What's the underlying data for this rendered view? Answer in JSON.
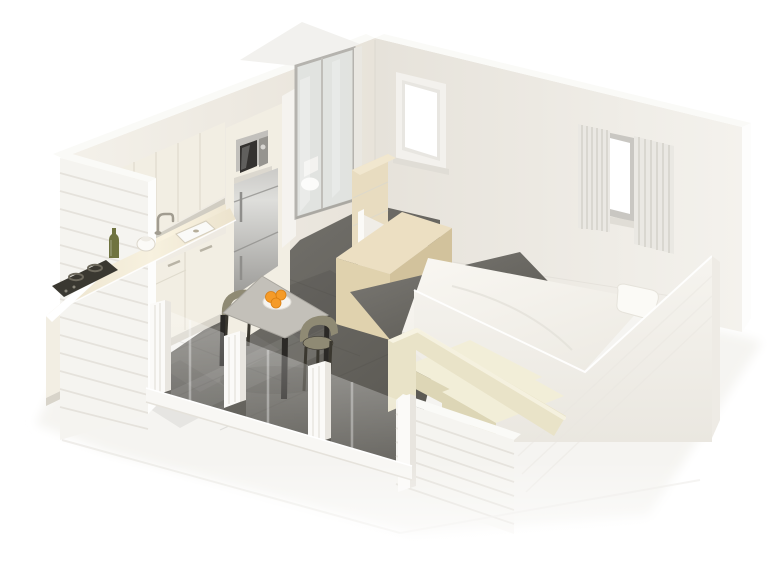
{
  "meta": {
    "title": "3D isometric cutaway floor plan of a small studio cabin",
    "type": "architectural-render",
    "view": "isometric-cutaway",
    "background": "white"
  },
  "scene": {
    "rooms": [
      {
        "name": "kitchen-dining",
        "furniture": [
          "upper cabinets",
          "countertop with sink and faucet",
          "cooktop",
          "base cabinets",
          "fridge",
          "microwave",
          "oil bottle",
          "kettle",
          "square dining table",
          "two olive chairs",
          "plate of oranges"
        ]
      },
      {
        "name": "bathroom",
        "furniture": [
          "glass shower-cabin enclosure",
          "toilet",
          "wooden vanity"
        ]
      },
      {
        "name": "bedroom-living",
        "furniture": [
          "double bed with white duvet",
          "pillow",
          "cream sofa",
          "wooden desk",
          "divider panel"
        ]
      }
    ],
    "openings": [
      "plain window on back-right wall",
      "curtained window on back-right wall",
      "glazed front with white mullions",
      "clapboard exterior walls"
    ]
  },
  "colors": {
    "bg": "#ffffff",
    "slab": "#f5f4f1",
    "wallTop": "#fafaf7",
    "wallNWl": "#f4f1ea",
    "wallNWr": "#e8e3da",
    "wallNEl": "#e6e2da",
    "wallNEr": "#f4f2ed",
    "wallCut": "#fdfdfc",
    "clapFace": "#f5f4f0",
    "clapLine": "#e3e0d9",
    "cabinet": "#f2eee3",
    "cabinetSeam": "#ded9cb",
    "cabinetShadow": "#c9c5ba",
    "counterA": "#f7f1df",
    "counterB": "#ece3cd",
    "backsplashA": "#faf3e0",
    "backsplashB": "#efe7d3",
    "cooktop": "#3a3831",
    "burner": "#6e6a5e",
    "steelA": "#cbcac7",
    "steelHi": "#dededb",
    "steelB": "#9c9b98",
    "steelSeam": "#8e8d8a",
    "mwFrame": "#c2c0bc",
    "mwGlass": "#343230",
    "mwPanel": "#96948f",
    "bathTop": "#f2f1ee",
    "bathSide": "#f5f3ef",
    "glassTint": "#dfe3df",
    "glassFrame": "#b5b3ae",
    "toilet": "#fbfbf9",
    "floorA": "#7d7b76",
    "floorB": "#55534d",
    "grout": "#3f3d38",
    "tableTopA": "#c3c0b9",
    "tableTopB": "#a8a59e",
    "tableLeg": "#2b2926",
    "chair": "#8f8a74",
    "chairLeg": "#3a372f",
    "plate": "#f5f4f1",
    "plateRim": "#dedbd4",
    "orange": "#f59b28",
    "orangeStroke": "#d97f12",
    "deskTop": "#ecdfc2",
    "deskFront": "#e0d2ae",
    "deskSide": "#d2c29c",
    "vanityFront": "#e8dcc0",
    "vanityTop": "#f1e7cf",
    "partition": "#f0ede7",
    "partitionEdge": "#fbfaf7",
    "panelA": "#f6f4ef",
    "panelB": "#eae7e0",
    "seA": "#fdfdfb",
    "seB": "#efede7",
    "bedTopA": "#f9f7f2",
    "bedTopB": "#edeae3",
    "bedSide": "#edeae2",
    "pillow": "#fbfaf6",
    "pillowEdge": "#e6e3db",
    "sofaA": "#f2eed8",
    "sofaB": "#e9e3c8",
    "sofaC": "#ddd6b6",
    "sofaHi": "#f7f3e2",
    "curtain": "#eae8e3",
    "curtainFold": "#d6d3cc",
    "curtainHi": "#f5f4f1",
    "windowFrame": "#f3f1ed",
    "windowFrameInner": "#e8e6e1",
    "windowGlass": "#ffffff",
    "sill": "#e0ddd6",
    "railFace": "#f8f7f4",
    "railShadow": "#e5e2db",
    "mullion": "#fbfaf8",
    "mullionSide": "#e8e5df",
    "edgeHi": "#ffffff",
    "cornerLine": "#d9d5ce",
    "white": "#ffffff"
  }
}
